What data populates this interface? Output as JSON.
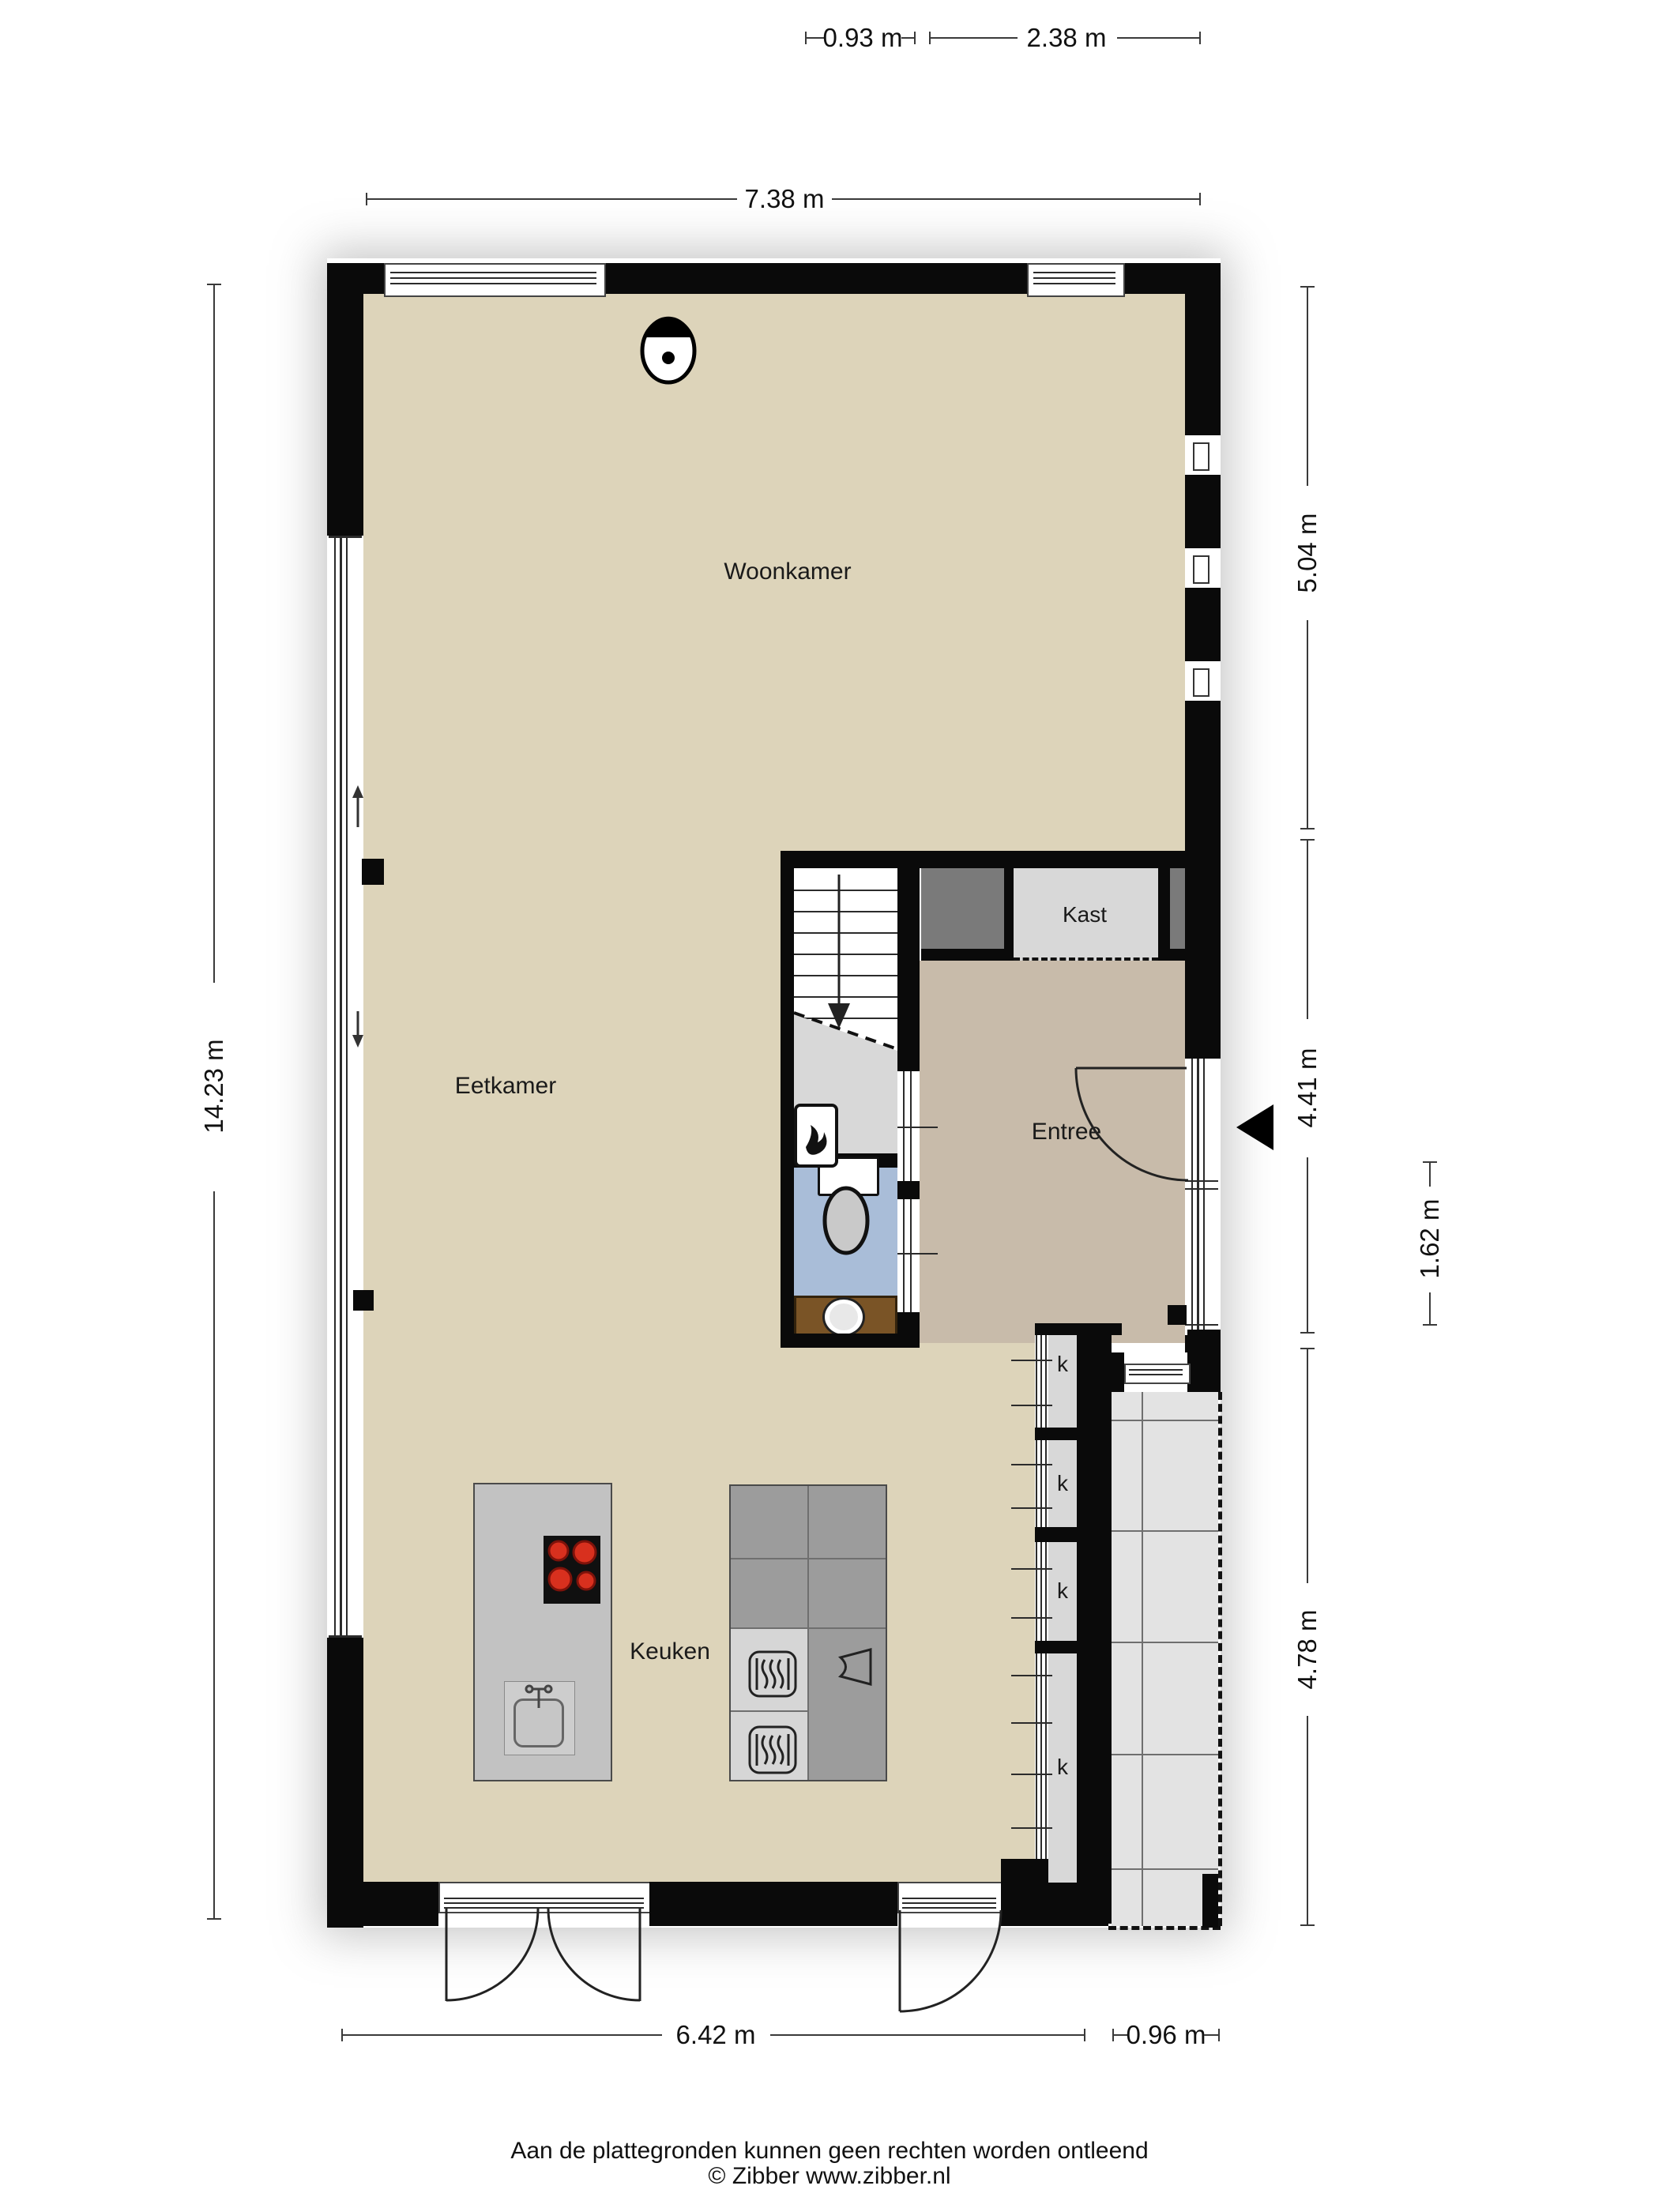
{
  "plan": {
    "type": "floorplan",
    "floor": "begane grond",
    "source_note": "Aan de plattegronden kunnen geen rechten worden ontleend",
    "copyright": "© Zibber www.zibber.nl"
  },
  "rooms": {
    "woonkamer": "Woonkamer",
    "eetkamer": "Eetkamer",
    "keuken": "Keuken",
    "entree": "Entree",
    "kast_upper": "Kast",
    "kast_under_stairs": "Kast",
    "cupboard_marker": "k"
  },
  "dimensions": {
    "top_offset": "0.93 m",
    "top_right_width": "2.38 m",
    "top_total_width": "7.38 m",
    "left_total_height": "14.23 m",
    "right_upper": "5.04 m",
    "right_middle": "4.41 m",
    "right_entry": "1.62 m",
    "right_lower": "4.78 m",
    "bottom_width": "6.42 m",
    "bottom_terrace": "0.96 m"
  },
  "colors": {
    "wall": "#0a0a0a",
    "floor_main": "#ddd4ba",
    "floor_entree": "#c8bbaa",
    "floor_wc": "#a9bdd8",
    "closet_gray": "#d8d8d8",
    "storage_dark": "#7a7a7a",
    "terrace": "#e3e3e3",
    "counter_dark": "#9c9c9c",
    "counter_light": "#d6d6d6",
    "island": "#c2c2c2",
    "vanity_brown": "#7a5426",
    "burner_red": "#d8301e"
  }
}
